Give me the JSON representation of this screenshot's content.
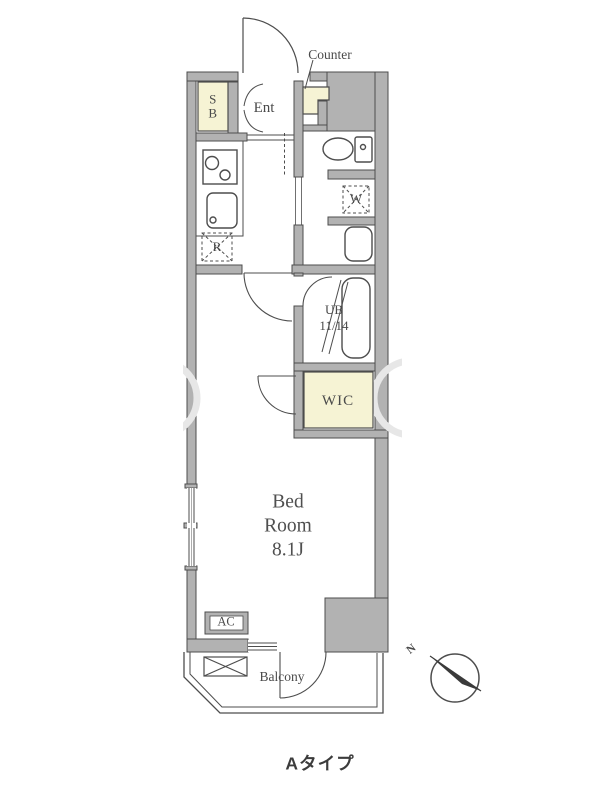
{
  "plan": {
    "title": "Aタイプ",
    "labels": {
      "counter": "Counter",
      "shoe_box_line1": "S",
      "shoe_box_line2": "B",
      "entrance": "Ent",
      "refrigerator": "R",
      "washer": "W",
      "unit_bath": "UB",
      "unit_bath_size": "11/14",
      "wic": "WIC",
      "bedroom_line1": "Bed",
      "bedroom_line2": "Room",
      "bedroom_size": "8.1J",
      "ac": "AC",
      "balcony": "Balcony",
      "compass_north": "N"
    },
    "colors": {
      "wall_fill": "#b2b2b2",
      "wall_outline": "#4d4d4d",
      "fixture_fill": "#f6f3d4",
      "label_text": "#4a4a4a",
      "title_text": "#3c3c3c",
      "watermark": "#e7e7e7"
    }
  }
}
